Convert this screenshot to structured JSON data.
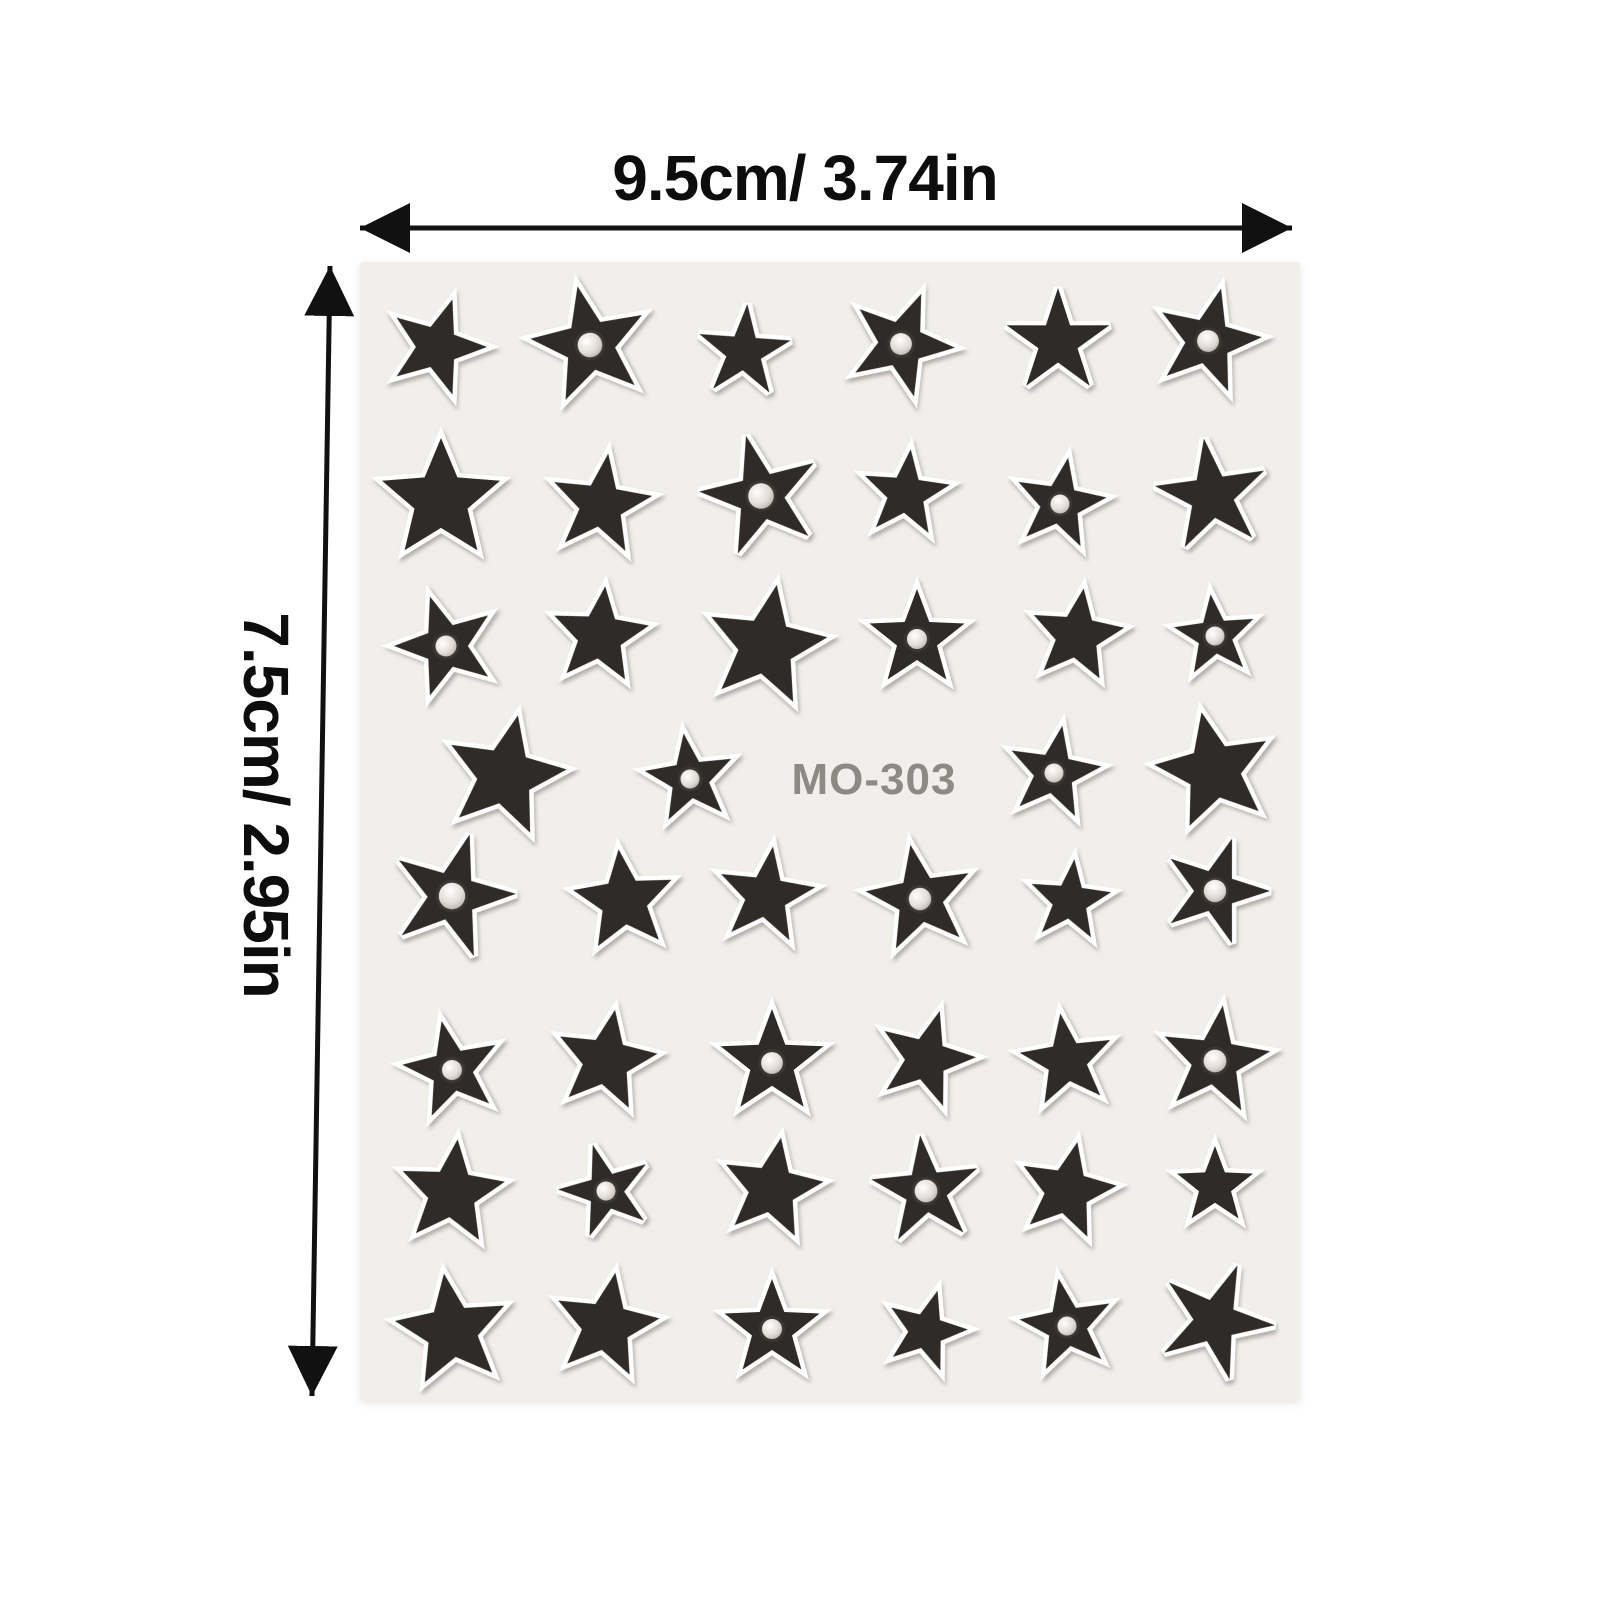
{
  "dimensions": {
    "top_label": "9.5cm/ 3.74in",
    "left_label": "7.5cm/ 2.95in",
    "arrow_color": "#111111",
    "label_color": "#0d0d0d"
  },
  "sheet": {
    "label": "MO-303",
    "label_color": "#8d8a86",
    "bg_color": "#f1efec",
    "star_color": "#2f2b28",
    "outline_color": "#ffffff",
    "gem_ring_color": "#3a3632",
    "x": 360,
    "y": 262,
    "width": 940,
    "height": 1138,
    "label_pos": {
      "x": 874,
      "y": 794
    },
    "star_ratio_default": 0.42,
    "stars": [
      {
        "x": 437,
        "y": 347,
        "r": 50,
        "rot": 18,
        "gem": 0
      },
      {
        "x": 590,
        "y": 345,
        "r": 60,
        "rot": -12,
        "gem": 1
      },
      {
        "x": 744,
        "y": 352,
        "r": 48,
        "rot": 4,
        "gem": 0,
        "ratio": 0.38
      },
      {
        "x": 901,
        "y": 344,
        "r": 54,
        "rot": 22,
        "gem": 1
      },
      {
        "x": 1058,
        "y": 342,
        "r": 54,
        "rot": 0,
        "gem": 0,
        "ratio": 0.38
      },
      {
        "x": 1208,
        "y": 341,
        "r": 54,
        "rot": 14,
        "gem": 1
      },
      {
        "x": 441,
        "y": 500,
        "r": 62,
        "rot": 0,
        "gem": 0,
        "ratio": 0.45
      },
      {
        "x": 601,
        "y": 505,
        "r": 52,
        "rot": 8,
        "gem": 0
      },
      {
        "x": 761,
        "y": 496,
        "r": 62,
        "rot": -14,
        "gem": 1,
        "ratio": 0.38
      },
      {
        "x": 906,
        "y": 494,
        "r": 45,
        "rot": 6,
        "gem": 0
      },
      {
        "x": 1060,
        "y": 504,
        "r": 47,
        "rot": 10,
        "gem": 1
      },
      {
        "x": 1212,
        "y": 496,
        "r": 58,
        "rot": -8,
        "gem": 0,
        "ratio": 0.38
      },
      {
        "x": 446,
        "y": 646,
        "r": 52,
        "rot": -18,
        "gem": 1
      },
      {
        "x": 600,
        "y": 636,
        "r": 50,
        "rot": 6,
        "gem": 0,
        "ratio": 0.45
      },
      {
        "x": 766,
        "y": 646,
        "r": 62,
        "rot": 10,
        "gem": 0,
        "ratio": 0.45
      },
      {
        "x": 917,
        "y": 639,
        "r": 50,
        "rot": 0,
        "gem": 1
      },
      {
        "x": 1077,
        "y": 636,
        "r": 48,
        "rot": 8,
        "gem": 0,
        "ratio": 0.45
      },
      {
        "x": 1215,
        "y": 636,
        "r": 42,
        "rot": -6,
        "gem": 1
      },
      {
        "x": 505,
        "y": 776,
        "r": 62,
        "rot": 12,
        "gem": 0,
        "ratio": 0.45
      },
      {
        "x": 690,
        "y": 779,
        "r": 46,
        "rot": -8,
        "gem": 1
      },
      {
        "x": 1054,
        "y": 773,
        "r": 48,
        "rot": 10,
        "gem": 1
      },
      {
        "x": 1214,
        "y": 771,
        "r": 60,
        "rot": -12,
        "gem": 0,
        "ratio": 0.45
      },
      {
        "x": 452,
        "y": 896,
        "r": 64,
        "rot": 16,
        "gem": 1,
        "ratio": 0.38
      },
      {
        "x": 624,
        "y": 901,
        "r": 52,
        "rot": -6,
        "gem": 0,
        "ratio": 0.45
      },
      {
        "x": 766,
        "y": 896,
        "r": 50,
        "rot": 8,
        "gem": 0
      },
      {
        "x": 920,
        "y": 899,
        "r": 55,
        "rot": -10,
        "gem": 1
      },
      {
        "x": 1070,
        "y": 901,
        "r": 42,
        "rot": 6,
        "gem": 0
      },
      {
        "x": 1215,
        "y": 891,
        "r": 55,
        "rot": 18,
        "gem": 1,
        "ratio": 0.38
      },
      {
        "x": 452,
        "y": 1070,
        "r": 50,
        "rot": -12,
        "gem": 1
      },
      {
        "x": 606,
        "y": 1061,
        "r": 52,
        "rot": 10,
        "gem": 0,
        "ratio": 0.45
      },
      {
        "x": 772,
        "y": 1063,
        "r": 54,
        "rot": 0,
        "gem": 1
      },
      {
        "x": 926,
        "y": 1059,
        "r": 50,
        "rot": 16,
        "gem": 0
      },
      {
        "x": 1067,
        "y": 1061,
        "r": 48,
        "rot": -8,
        "gem": 0
      },
      {
        "x": 1215,
        "y": 1061,
        "r": 56,
        "rot": 8,
        "gem": 1
      },
      {
        "x": 452,
        "y": 1193,
        "r": 54,
        "rot": 6,
        "gem": 0,
        "ratio": 0.45
      },
      {
        "x": 606,
        "y": 1191,
        "r": 48,
        "rot": -16,
        "gem": 1,
        "ratio": 0.38
      },
      {
        "x": 772,
        "y": 1189,
        "r": 52,
        "rot": 10,
        "gem": 0,
        "ratio": 0.45
      },
      {
        "x": 926,
        "y": 1191,
        "r": 56,
        "rot": -6,
        "gem": 1,
        "ratio": 0.38
      },
      {
        "x": 1067,
        "y": 1191,
        "r": 50,
        "rot": 12,
        "gem": 0,
        "ratio": 0.45
      },
      {
        "x": 1215,
        "y": 1186,
        "r": 40,
        "rot": 0,
        "gem": 0
      },
      {
        "x": 452,
        "y": 1331,
        "r": 58,
        "rot": -8,
        "gem": 0,
        "ratio": 0.45
      },
      {
        "x": 606,
        "y": 1326,
        "r": 54,
        "rot": 10,
        "gem": 0,
        "ratio": 0.45
      },
      {
        "x": 772,
        "y": 1329,
        "r": 50,
        "rot": 0,
        "gem": 1
      },
      {
        "x": 926,
        "y": 1331,
        "r": 42,
        "rot": 16,
        "gem": 0
      },
      {
        "x": 1067,
        "y": 1326,
        "r": 48,
        "rot": -10,
        "gem": 1
      },
      {
        "x": 1215,
        "y": 1321,
        "r": 60,
        "rot": 22,
        "gem": 0,
        "ratio": 0.36
      }
    ]
  }
}
